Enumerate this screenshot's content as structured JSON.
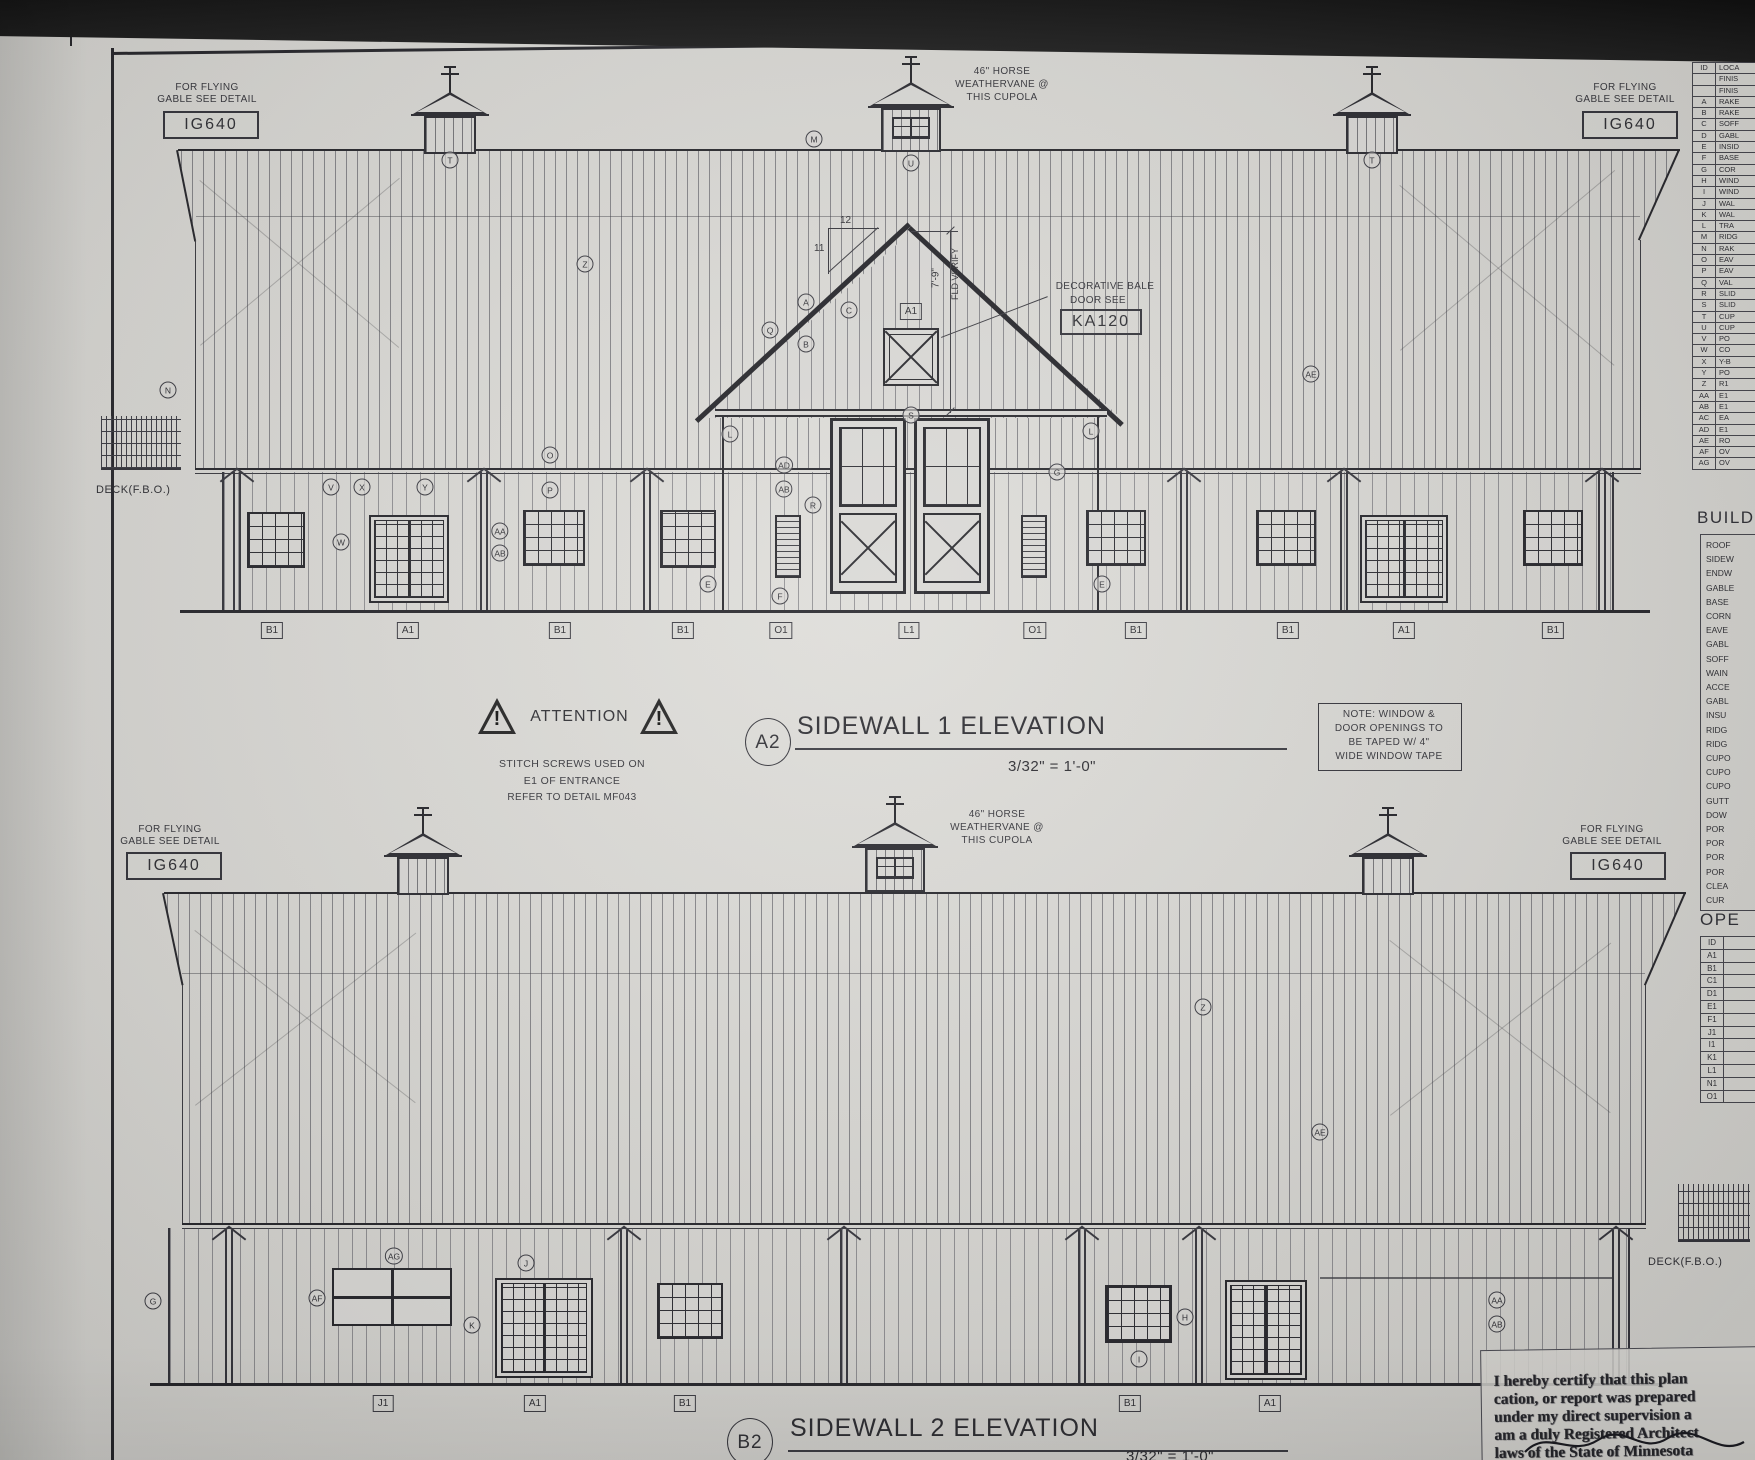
{
  "elevation1": {
    "drawing_number": "A2",
    "title": "SIDEWALL 1 ELEVATION",
    "scale": "3/32\" = 1'-0\"",
    "flying_gable_line1": "FOR FLYING",
    "flying_gable_line2": "GABLE SEE DETAIL",
    "flying_gable_detail": "IG640",
    "weathervane_lines": [
      "46\" HORSE",
      "WEATHERVANE @",
      "THIS CUPOLA"
    ],
    "bale_line1": "DECORATIVE BALE",
    "bale_line2": "DOOR SEE",
    "bale_detail": "KA120",
    "hay_door_tag": "A1",
    "pitch_run": "12",
    "pitch_rise": "11",
    "dim": "7'-9\"",
    "dim_note": "FLD VERIFY",
    "deck_label": "DECK(F.B.O.)",
    "refs": [
      {
        "t": "N",
        "x": 168,
        "y": 390
      },
      {
        "t": "T",
        "x": 450,
        "y": 160
      },
      {
        "t": "Z",
        "x": 585,
        "y": 264
      },
      {
        "t": "M",
        "x": 814,
        "y": 139
      },
      {
        "t": "U",
        "x": 911,
        "y": 163
      },
      {
        "t": "T",
        "x": 1372,
        "y": 160
      },
      {
        "t": "AE",
        "x": 1311,
        "y": 374
      },
      {
        "t": "A",
        "x": 806,
        "y": 302
      },
      {
        "t": "Q",
        "x": 770,
        "y": 330
      },
      {
        "t": "B",
        "x": 806,
        "y": 344
      },
      {
        "t": "C",
        "x": 849,
        "y": 310
      },
      {
        "t": "L",
        "x": 730,
        "y": 434
      },
      {
        "t": "S",
        "x": 911,
        "y": 415
      },
      {
        "t": "L",
        "x": 1091,
        "y": 431
      },
      {
        "t": "G",
        "x": 1057,
        "y": 472
      },
      {
        "t": "AD",
        "x": 784,
        "y": 465
      },
      {
        "t": "AB",
        "x": 784,
        "y": 489
      },
      {
        "t": "R",
        "x": 813,
        "y": 505
      },
      {
        "t": "V",
        "x": 331,
        "y": 487
      },
      {
        "t": "X",
        "x": 362,
        "y": 487
      },
      {
        "t": "Y",
        "x": 425,
        "y": 487
      },
      {
        "t": "W",
        "x": 341,
        "y": 542
      },
      {
        "t": "AA",
        "x": 500,
        "y": 531
      },
      {
        "t": "AB",
        "x": 500,
        "y": 553
      },
      {
        "t": "O",
        "x": 550,
        "y": 455
      },
      {
        "t": "P",
        "x": 550,
        "y": 490
      },
      {
        "t": "E",
        "x": 708,
        "y": 584
      },
      {
        "t": "F",
        "x": 780,
        "y": 596
      },
      {
        "t": "E",
        "x": 1102,
        "y": 584
      }
    ],
    "opening_labels": [
      {
        "t": "B1",
        "x": 272
      },
      {
        "t": "A1",
        "x": 408
      },
      {
        "t": "B1",
        "x": 560
      },
      {
        "t": "B1",
        "x": 683
      },
      {
        "t": "O1",
        "x": 781
      },
      {
        "t": "L1",
        "x": 909
      },
      {
        "t": "O1",
        "x": 1035
      },
      {
        "t": "B1",
        "x": 1136
      },
      {
        "t": "B1",
        "x": 1288
      },
      {
        "t": "A1",
        "x": 1404
      },
      {
        "t": "B1",
        "x": 1553
      }
    ]
  },
  "attention": {
    "title": "ATTENTION",
    "lines": [
      "STITCH SCREWS USED ON",
      "E1 OF ENTRANCE",
      "REFER TO DETAIL MF043"
    ]
  },
  "window_note": [
    "NOTE: WINDOW &",
    "DOOR OPENINGS TO",
    "BE TAPED W/ 4\"",
    "WIDE WINDOW TAPE"
  ],
  "elevation2": {
    "drawing_number": "B2",
    "title": "SIDEWALL 2 ELEVATION",
    "scale": "3/32\" = 1'-0\"",
    "flying_gable_line1": "FOR FLYING",
    "flying_gable_line2": "GABLE SEE DETAIL",
    "flying_gable_detail": "IG640",
    "weathervane_lines": [
      "46\" HORSE",
      "WEATHERVANE @",
      "THIS CUPOLA"
    ],
    "deck_label": "DECK(F.B.O.)",
    "refs": [
      {
        "t": "Z",
        "x": 1203,
        "y": 1007
      },
      {
        "t": "AE",
        "x": 1320,
        "y": 1132
      },
      {
        "t": "G",
        "x": 153,
        "y": 1301
      },
      {
        "t": "AG",
        "x": 394,
        "y": 1256
      },
      {
        "t": "J",
        "x": 526,
        "y": 1263
      },
      {
        "t": "AF",
        "x": 317,
        "y": 1298
      },
      {
        "t": "K",
        "x": 472,
        "y": 1325
      },
      {
        "t": "H",
        "x": 1185,
        "y": 1317
      },
      {
        "t": "I",
        "x": 1139,
        "y": 1359
      },
      {
        "t": "AA",
        "x": 1497,
        "y": 1300
      },
      {
        "t": "AB",
        "x": 1497,
        "y": 1324
      }
    ],
    "opening_labels": [
      {
        "t": "J1",
        "x": 383
      },
      {
        "t": "A1",
        "x": 535
      },
      {
        "t": "B1",
        "x": 685
      },
      {
        "t": "B1",
        "x": 1130
      },
      {
        "t": "A1",
        "x": 1270
      }
    ]
  },
  "panels": {
    "finish": {
      "title": "FINISH",
      "header": [
        "ID",
        "LOCA"
      ],
      "rows": [
        [
          "",
          "FINIS"
        ],
        [
          "",
          "FINIS"
        ],
        [
          "A",
          "RAKE"
        ],
        [
          "B",
          "RAKE"
        ],
        [
          "C",
          "SOFF"
        ],
        [
          "D",
          "GABL"
        ],
        [
          "E",
          "INSID"
        ],
        [
          "F",
          "BASE"
        ],
        [
          "G",
          "COR"
        ],
        [
          "H",
          "WIND"
        ],
        [
          "I",
          "WIND"
        ],
        [
          "J",
          "WAL"
        ],
        [
          "K",
          "WAL"
        ],
        [
          "L",
          "TRA"
        ],
        [
          "M",
          "RIDG"
        ],
        [
          "N",
          "RAK"
        ],
        [
          "O",
          "EAV"
        ],
        [
          "P",
          "EAV"
        ],
        [
          "Q",
          "VAL"
        ],
        [
          "R",
          "SLID"
        ],
        [
          "S",
          "SLID"
        ],
        [
          "T",
          "CUP"
        ],
        [
          "U",
          "CUP"
        ],
        [
          "V",
          "PO"
        ],
        [
          "W",
          "CO"
        ],
        [
          "X",
          "Y-B"
        ],
        [
          "Y",
          "PO"
        ],
        [
          "Z",
          "R1"
        ],
        [
          "AA",
          "E1"
        ],
        [
          "AB",
          "E1"
        ],
        [
          "AC",
          "EA"
        ],
        [
          "AD",
          "E1"
        ],
        [
          "AE",
          "RO"
        ],
        [
          "AF",
          "OV"
        ],
        [
          "AG",
          "OV"
        ]
      ]
    },
    "build": {
      "title": "BUILD",
      "items": [
        "ROOF",
        "SIDEW",
        "ENDW",
        "GABLE",
        "BASE",
        "CORN",
        "EAVE",
        "GABL",
        "SOFF",
        "WAIN",
        "ACCE",
        "GABL",
        "INSU",
        "RIDG",
        "RIDG",
        "CUPO",
        "CUPO",
        "CUPO",
        "GUTT",
        "DOW",
        "POR",
        "POR",
        "POR",
        "POR",
        "CLEA",
        "CUR"
      ]
    },
    "openings": {
      "title": "OPE",
      "rows": [
        "ID",
        "A1",
        "B1",
        "C1",
        "D1",
        "E1",
        "F1",
        "J1",
        "I1",
        "K1",
        "L1",
        "N1",
        "O1"
      ]
    }
  },
  "stamp": {
    "lines": [
      "I hereby certify that this plan",
      "cation, or report was prepared",
      "under my direct supervision a",
      "am a duly Registered Architect",
      "laws of the State of Minnesota"
    ]
  }
}
